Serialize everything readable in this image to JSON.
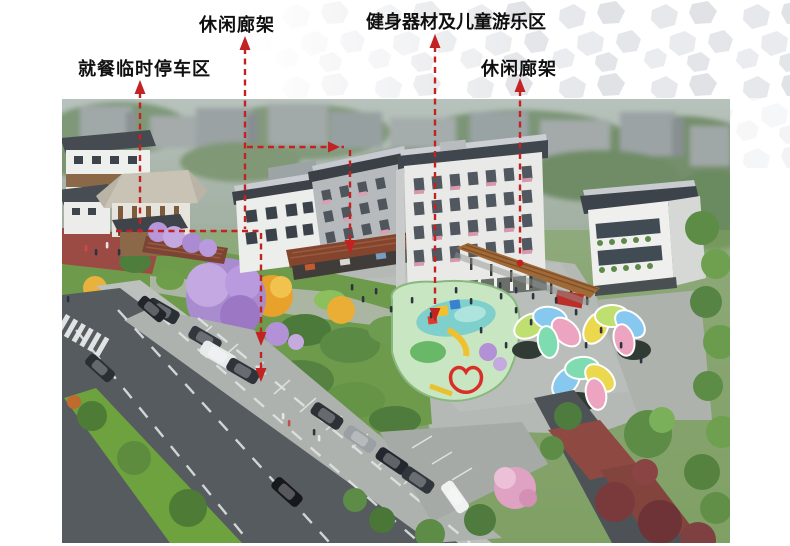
{
  "annotations": {
    "line_color": "#c32222",
    "labels": [
      {
        "id": "leisure-gallery-top",
        "text": "休闲廊架"
      },
      {
        "id": "fitness-children-area",
        "text": "健身器材及儿童游乐区"
      },
      {
        "id": "dining-parking",
        "text": "就餐临时停车区"
      },
      {
        "id": "leisure-gallery-right",
        "text": "休闲廊架"
      }
    ]
  },
  "scene": {
    "type": "aerial-architectural-rendering",
    "palette": {
      "annotation_red": "#c32222",
      "roof_dark": "#41464c",
      "wall_white": "#eceeeb",
      "pergola_wood": "#84452f",
      "plaza_gray": "#b5b9b5",
      "road_asphalt": "#565b60",
      "median_green": "#6da23e",
      "purple_tree": "#b392d8",
      "golden_tree": "#e8a22c",
      "playground_green": "#c9e6c2",
      "petal_green": "#bfe070",
      "petal_blue": "#86c8ee",
      "petal_yellow": "#ecd84e",
      "petal_pink": "#eda4c0",
      "petal_mint": "#7edcb0",
      "red_paving": "#9c4a44"
    }
  }
}
